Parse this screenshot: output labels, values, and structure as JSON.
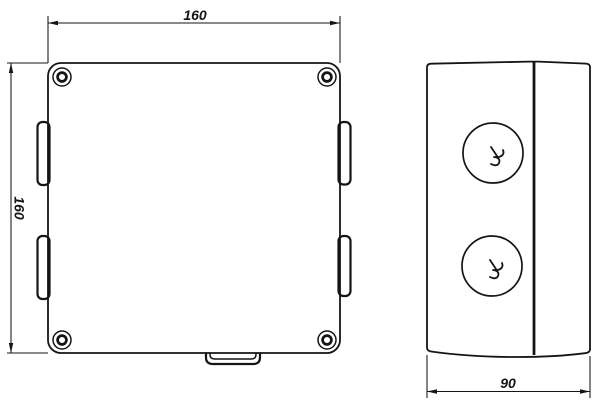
{
  "drawing": {
    "background_color": "#ffffff",
    "line_color": "#151515",
    "front_view": {
      "width_label": "160",
      "height_label": "160"
    },
    "side_view": {
      "depth_label": "90"
    }
  }
}
